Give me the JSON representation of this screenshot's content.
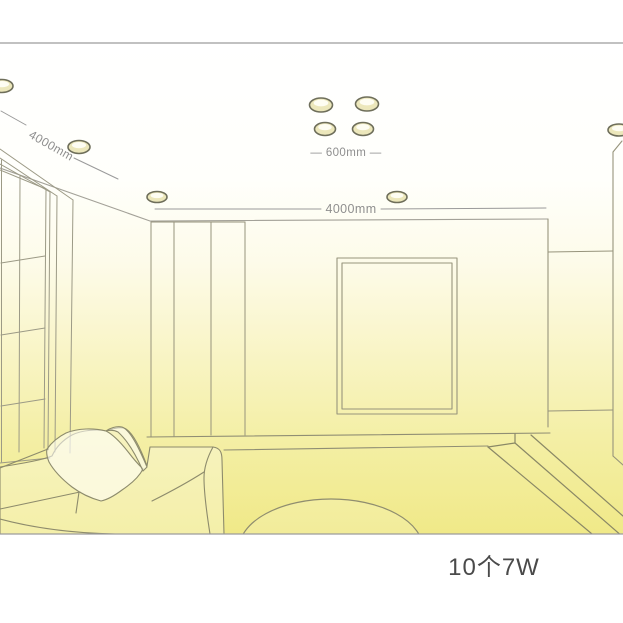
{
  "diagram": {
    "type": "room-lighting-layout",
    "labels": {
      "left_ceiling_dimension": "4000mm",
      "light_spacing_dimension": "— 600mm —",
      "back_wall_dimension": "4000mm",
      "power_summary": "10个7W"
    },
    "lights_total": 10,
    "watt_per_light": "7W",
    "colors": {
      "floor_glow": "#f0e988",
      "light_ring_stroke": "#6e6e5a",
      "light_ring_fill": "#ece7bb",
      "light_inner_fill": "#fefdf2",
      "dimension_text": "#8f8f8f",
      "power_text": "#4a4a4a",
      "room_line": "#8f8d73",
      "border_line": "#9c9c9c"
    },
    "lights": [
      {
        "x": 2,
        "y": 86,
        "rx": 11,
        "ry": 6.5
      },
      {
        "x": 79,
        "y": 147,
        "rx": 11,
        "ry": 6.5
      },
      {
        "x": 157,
        "y": 197,
        "rx": 10,
        "ry": 5.5
      },
      {
        "x": 321,
        "y": 105,
        "rx": 11.5,
        "ry": 7
      },
      {
        "x": 367,
        "y": 104,
        "rx": 11.5,
        "ry": 7
      },
      {
        "x": 325,
        "y": 129,
        "rx": 10.5,
        "ry": 6.5
      },
      {
        "x": 363,
        "y": 129,
        "rx": 10.5,
        "ry": 6.5
      },
      {
        "x": 397,
        "y": 197,
        "rx": 10,
        "ry": 5.5
      },
      {
        "x": 619,
        "y": 130,
        "rx": 11,
        "ry": 6
      }
    ]
  }
}
